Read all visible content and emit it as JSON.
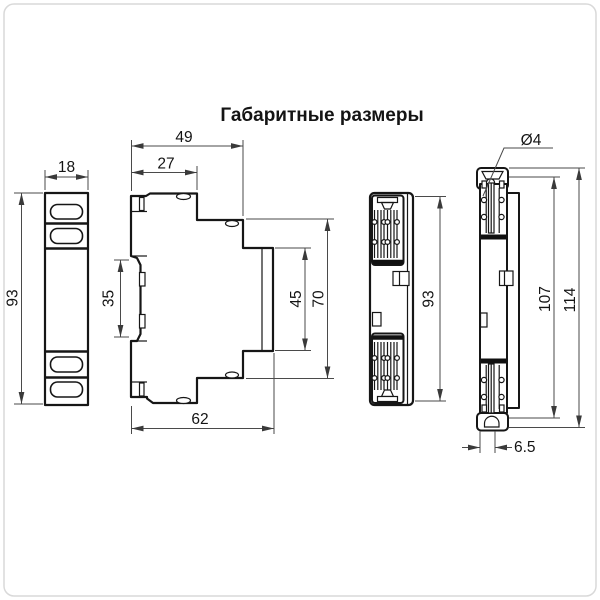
{
  "title": "Габаритные размеры",
  "front_view": {
    "width": "18",
    "height": "93"
  },
  "side_view": {
    "overall_top_width": "49",
    "upper_step_width": "27",
    "din_clip_span": "35",
    "front_panel_height": "45",
    "body_height": "70",
    "overall_depth": "62"
  },
  "rear_view": {
    "height": "93"
  },
  "edge_view": {
    "hole_diameter": "Ø4",
    "inner_height": "107",
    "overall_height": "114",
    "foot_depth": "6.5"
  },
  "colors": {
    "line": "#161616",
    "dim_line": "#4a4a4a",
    "background": "#ffffff",
    "frame": "#d9d9d9"
  }
}
